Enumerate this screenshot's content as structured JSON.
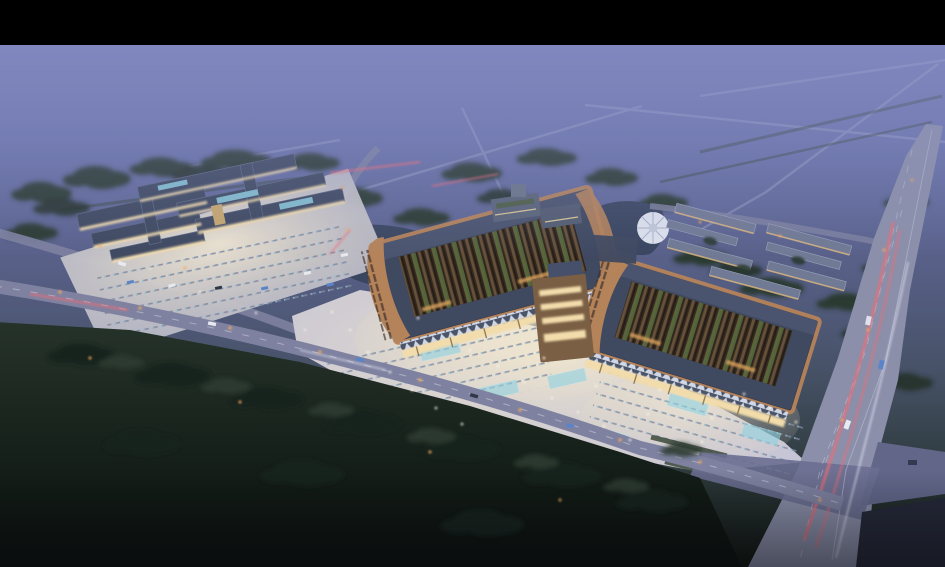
{
  "scene": {
    "kind": "aerial-architectural-rendering",
    "time_of_day": "dusk",
    "subject": "large twin-courtyard market hall complex with illuminated plaza, ponds, parking lots, tree belts, frontage road and highway with light trails",
    "letterbox_top_px": 45
  },
  "palette": {
    "letterbox": "#000000",
    "sky_top": "#7079b4",
    "sky_mid": "#5f6890",
    "land": "#3a4752",
    "tree_dark": "#2c3a31",
    "tree_fg": "#19231c",
    "roof_slate": "#3f4960",
    "roof_ridge": "#5a6580",
    "copper": "#b5835a",
    "courtyard": "#372b21",
    "stall_brown": "#66513a",
    "stall_green": "#57683c",
    "plaza": "#c6c5d6",
    "plaza_glow": "#f7ecd2",
    "facade_glow": "#f2dcab",
    "water": "#3a4660",
    "road": "#7e82a0",
    "highway": "#8b8fa9",
    "trail_red": "#ef6b75",
    "lamp_warm": "#f5a95e",
    "lamp_cool": "#f8f4e6",
    "canopy_teal": "#8fd2e2",
    "car_blue": "#5b84c8"
  },
  "regions": {
    "left_complex": "low-rise retail cluster with lit facades and parking",
    "hall_left": "west market hall with copper-edged roof and open courtyard",
    "hall_right": "east market hall with copper-edged roof and open courtyard",
    "central_gate": "bronze entrance gate linking the two halls",
    "fountain_plaza": "circular fountain plaza beside pond",
    "sheds": "rows of long shed buildings",
    "highway": "expressway with red tail-light trails",
    "front_road": "frontage road along the plaza",
    "foreground": "dark tree belt and meadow"
  }
}
